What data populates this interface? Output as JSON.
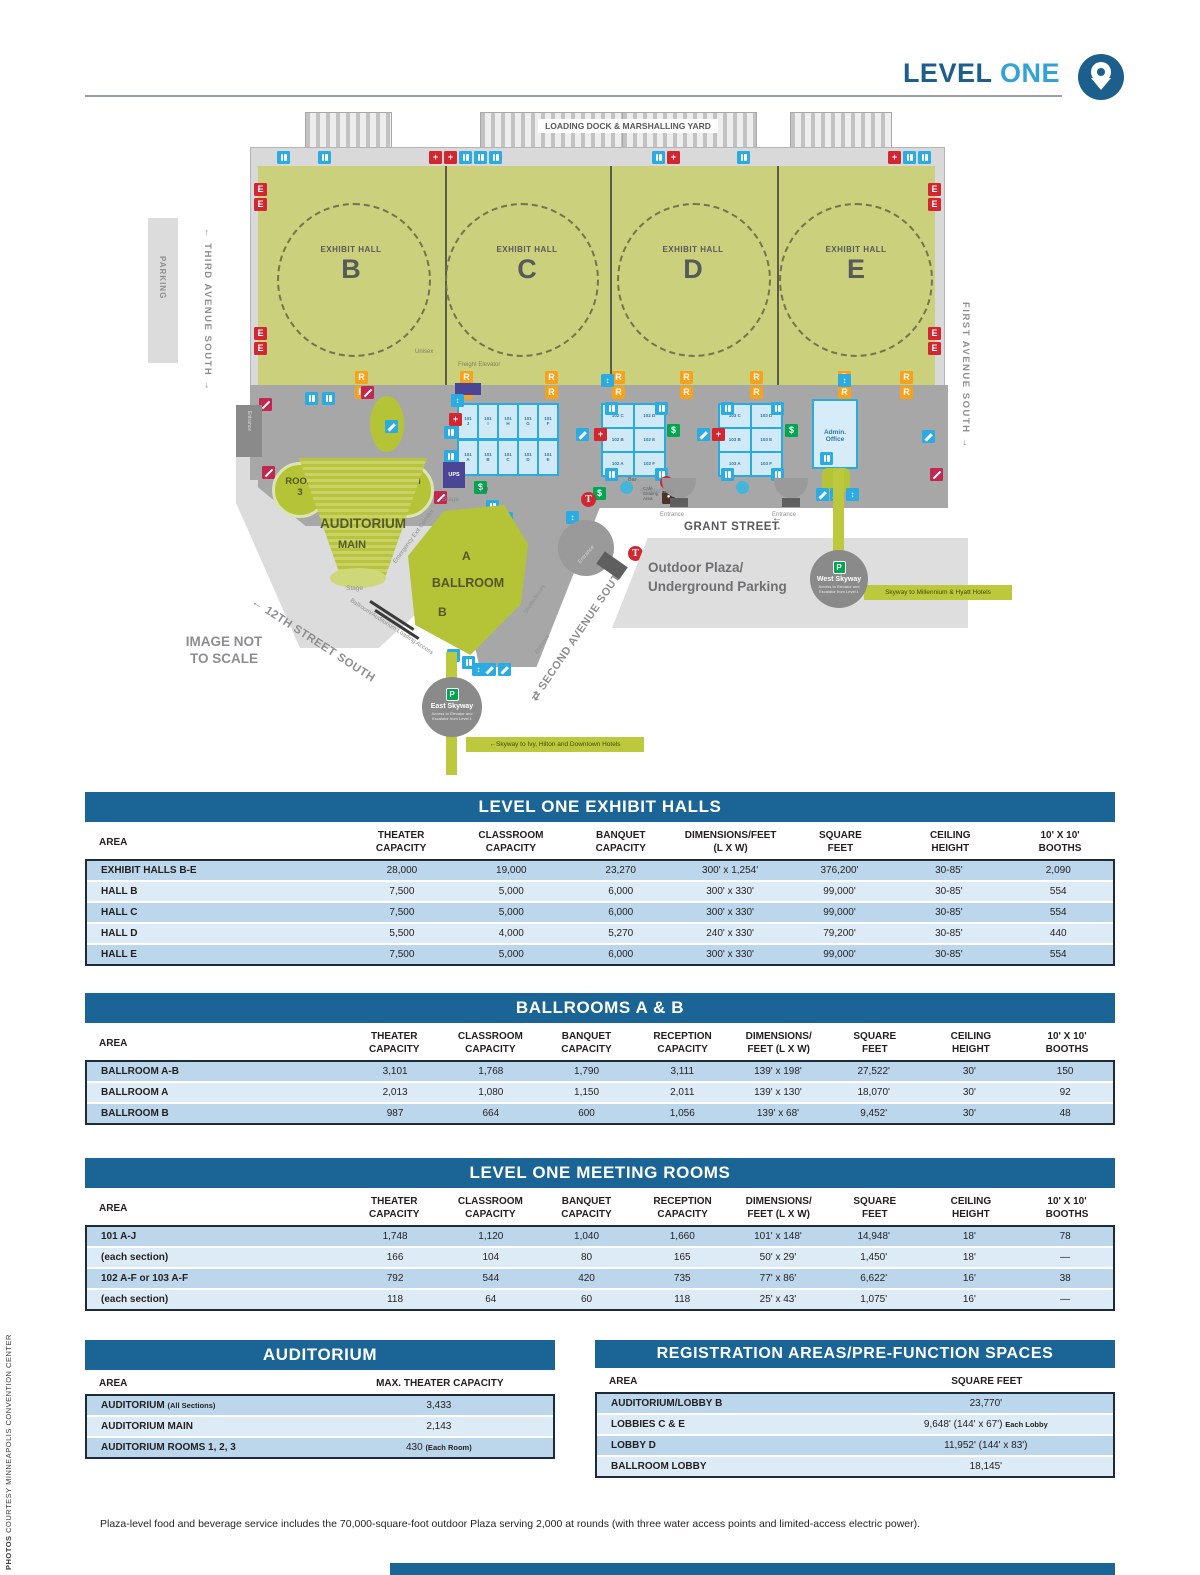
{
  "header": {
    "title_dark": "LEVEL",
    "title_light": "ONE"
  },
  "credit": {
    "bold": "PHOTOS",
    "text": " COURTESY MINNEAPOLIS CONVENTION CENTER"
  },
  "footnote": "Plaza-level food and beverage service includes the 70,000-square-foot outdoor Plaza serving 2,000 at rounds (with three water access points and limited-access electric power).",
  "icons": {
    "exit": "E",
    "reg": "R",
    "dollar": "$",
    "parking": "P",
    "transit": "T",
    "firstaid": "+",
    "elevator": "↕",
    "noentry": "–",
    "cafe": "●"
  },
  "colors": {
    "table_header_blue": "#1a6496",
    "row_dark": "#bcd7ec",
    "row_light": "#ddebf7",
    "hall_green": "#cbd07c",
    "accent_green": "#b5c437",
    "icon_blue": "#2aabe2",
    "badge_red": "#d22630",
    "badge_orange": "#f6a21d",
    "badge_green": "#00a650",
    "title_dark_blue": "#1d5f8c",
    "title_light_blue": "#33a3d6"
  },
  "map": {
    "loading_dock": "LOADING DOCK & MARSHALLING YARD",
    "halls": [
      {
        "label": "EXHIBIT HALL",
        "letter": "B"
      },
      {
        "label": "EXHIBIT HALL",
        "letter": "C"
      },
      {
        "label": "EXHIBIT HALL",
        "letter": "D"
      },
      {
        "label": "EXHIBIT HALL",
        "letter": "E"
      }
    ],
    "parking": "PARKING",
    "third_avenue": "←  THIRD AVENUE SOUTH  →",
    "first_avenue": "FIRST AVENUE SOUTH  →",
    "second_avenue": "⇄ SECOND AVENUE SOUTH",
    "twelfth_street": "←  12TH STREET SOUTH",
    "grant_street": "GRANT STREET",
    "arrow_left": "←",
    "arrow_right": "→",
    "image_note": "IMAGE NOT\nTO SCALE",
    "unisex": "Unisex",
    "freight_elevator": "Freight Elevator",
    "ups": "UPS",
    "tdd": "TDD",
    "bar": "Bar",
    "cafe_seating": "Café\nSeating\nArea",
    "rooms": [
      "ROOM\n3",
      "ROOM\n2",
      "ROOM\n1"
    ],
    "auditorium": "AUDITORIUM",
    "main": "MAIN",
    "stage": "Stage",
    "emergency_exit": "Emergency Exit Corridor",
    "ballroom": {
      "a": "A",
      "name": "BALLROOM",
      "b": "B"
    },
    "loading_access": "Ballroom/Auditorium Loading Access",
    "outdoor_plaza": "Outdoor Plaza/\nUnderground Parking",
    "entrance": "Entrance",
    "shuttle_taxis": "Shuttle/Taxis",
    "shuttle_buses": "Shuttle/Buses",
    "admin_office": "Admin.\nOffice",
    "west_skyway": {
      "name": "West Skyway",
      "sub": "Access to Elevator and Escalator from Level 1",
      "band": "Skyway to Millennium & Hyatt Hotels"
    },
    "east_skyway": {
      "name": "East Skyway",
      "sub": "Access to Elevator and Escalator from Level 1",
      "band": "←Skyway to Ivy, Hilton and Downtown Hotels"
    },
    "rooms_101_top": [
      "101\nJ",
      "101\nI",
      "101\nH",
      "101\nG",
      "101\nF"
    ],
    "rooms_101_bottom": [
      "101\nA",
      "101\nB",
      "101\nC",
      "101\nD",
      "101\nE"
    ],
    "rooms_102": [
      [
        "102 C",
        "102 D"
      ],
      [
        "102 B",
        "102 E"
      ],
      [
        "102 A",
        "102 F"
      ]
    ],
    "rooms_103": [
      [
        "103 C",
        "103 D"
      ],
      [
        "103 B",
        "103 E"
      ],
      [
        "103 A",
        "103 F"
      ]
    ]
  },
  "tables": {
    "exhibit": {
      "title": "LEVEL ONE EXHIBIT HALLS",
      "headers": [
        "AREA",
        "THEATER\nCAPACITY",
        "CLASSROOM\nCAPACITY",
        "BANQUET\nCAPACITY",
        "DIMENSIONS/FEET\n(L X W)",
        "SQUARE\nFEET",
        "CEILING\nHEIGHT",
        "10' X 10'\nBOOTHS"
      ],
      "rows": [
        [
          "EXHIBIT HALLS B-E",
          "28,000",
          "19,000",
          "23,270",
          "300' x 1,254'",
          "376,200'",
          "30-85'",
          "2,090"
        ],
        [
          "HALL B",
          "7,500",
          "5,000",
          "6,000",
          "300' x 330'",
          "99,000'",
          "30-85'",
          "554"
        ],
        [
          "HALL C",
          "7,500",
          "5,000",
          "6,000",
          "300' x 330'",
          "99,000'",
          "30-85'",
          "554"
        ],
        [
          "HALL D",
          "5,500",
          "4,000",
          "5,270",
          "240' x 330'",
          "79,200'",
          "30-85'",
          "440"
        ],
        [
          "HALL E",
          "7,500",
          "5,000",
          "6,000",
          "300' x 330'",
          "99,000'",
          "30-85'",
          "554"
        ]
      ]
    },
    "ballrooms": {
      "title": "BALLROOMS A & B",
      "headers": [
        "AREA",
        "THEATER\nCAPACITY",
        "CLASSROOM\nCAPACITY",
        "BANQUET\nCAPACITY",
        "RECEPTION\nCAPACITY",
        "DIMENSIONS/\nFEET (L X W)",
        "SQUARE\nFEET",
        "CEILING\nHEIGHT",
        "10' X 10'\nBOOTHS"
      ],
      "rows": [
        [
          "BALLROOM A-B",
          "3,101",
          "1,768",
          "1,790",
          "3,111",
          "139' x 198'",
          "27,522'",
          "30'",
          "150"
        ],
        [
          "BALLROOM A",
          "2,013",
          "1,080",
          "1,150",
          "2,011",
          "139' x 130'",
          "18,070'",
          "30'",
          "92"
        ],
        [
          "BALLROOM B",
          "987",
          "664",
          "600",
          "1,056",
          "139' x 68'",
          "9,452'",
          "30'",
          "48"
        ]
      ]
    },
    "meeting": {
      "title": "LEVEL ONE MEETING ROOMS",
      "headers": [
        "AREA",
        "THEATER\nCAPACITY",
        "CLASSROOM\nCAPACITY",
        "BANQUET\nCAPACITY",
        "RECEPTION\nCAPACITY",
        "DIMENSIONS/\nFEET (L X W)",
        "SQUARE\nFEET",
        "CEILING\nHEIGHT",
        "10' X 10'\nBOOTHS"
      ],
      "rows": [
        [
          "101 A-J",
          "1,748",
          "1,120",
          "1,040",
          "1,660",
          "101' x 148'",
          "14,948'",
          "18'",
          "78"
        ],
        [
          "(each section)",
          "166",
          "104",
          "80",
          "165",
          "50' x 29'",
          "1,450'",
          "18'",
          "—"
        ],
        [
          "102 A-F or 103 A-F",
          "792",
          "544",
          "420",
          "735",
          "77' x 86'",
          "6,622'",
          "16'",
          "38"
        ],
        [
          "(each section)",
          "118",
          "64",
          "60",
          "118",
          "25' x 43'",
          "1,075'",
          "16'",
          "—"
        ]
      ]
    },
    "auditorium": {
      "title": "AUDITORIUM",
      "headers": [
        "AREA",
        "MAX. THEATER CAPACITY"
      ],
      "rows": [
        {
          "area": "AUDITORIUM",
          "area_small": "(All Sections)",
          "value": "3,433"
        },
        {
          "area": "AUDITORIUM MAIN",
          "value": "2,143"
        },
        {
          "area": "AUDITORIUM ROOMS 1, 2, 3",
          "value": "430",
          "value_small": "(Each Room)"
        }
      ]
    },
    "registration": {
      "title": "REGISTRATION AREAS/PRE-FUNCTION SPACES",
      "headers": [
        "AREA",
        "SQUARE FEET"
      ],
      "rows": [
        {
          "area": "AUDITORIUM/LOBBY B",
          "value": "23,770'"
        },
        {
          "area": "LOBBIES C & E",
          "value": "9,648' (144' x 67')",
          "value_small": "Each Lobby"
        },
        {
          "area": "LOBBY D",
          "value": "11,952' (144' x 83')"
        },
        {
          "area": "BALLROOM LOBBY",
          "value": "18,145'"
        }
      ]
    }
  }
}
